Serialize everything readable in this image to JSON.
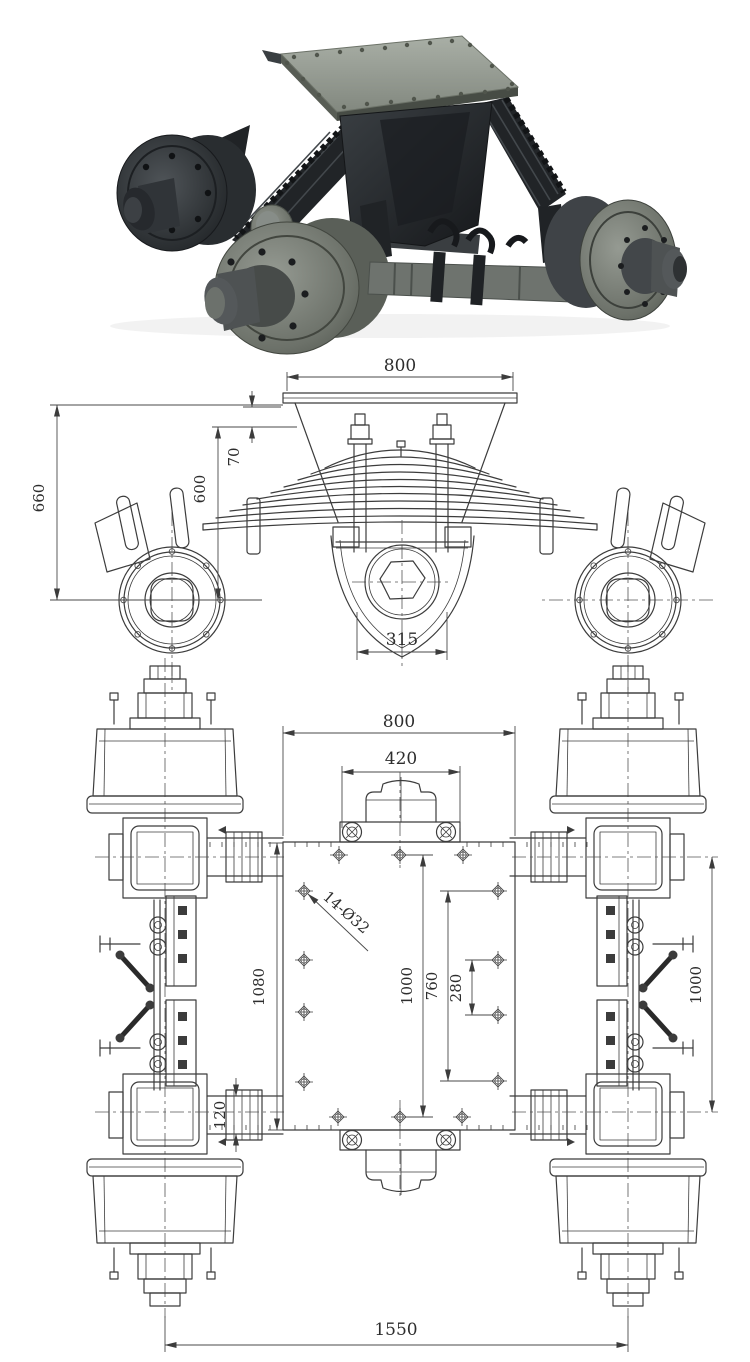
{
  "photo": {
    "alt": "tandem-axle bogie suspension unit"
  },
  "front_view": {
    "dim_top_plate_width": "800",
    "dim_plate_drop": "70",
    "dim_plate_to_axle_height": "600",
    "dim_overall_height": "660",
    "dim_trunnion_base_width": "315"
  },
  "plan_view": {
    "dim_plate_width": "800",
    "dim_cap_width": "420",
    "note_bolt_holes": "14-Ø32",
    "dim_plate_length": "1080",
    "dim_bolt_span_long": "1000",
    "dim_bolt_span_mid": "760",
    "dim_bolt_span_short": "280",
    "dim_beam_width": "120",
    "dim_axle_spacing": "1000",
    "dim_overall_track": "1550"
  },
  "colors": {
    "paper": "#ffffff",
    "line": "#3c3c3c",
    "dim_text": "#2d2d2d",
    "photo_dark": "#24272a",
    "photo_mid": "#565b57",
    "photo_light": "#9aa099"
  }
}
